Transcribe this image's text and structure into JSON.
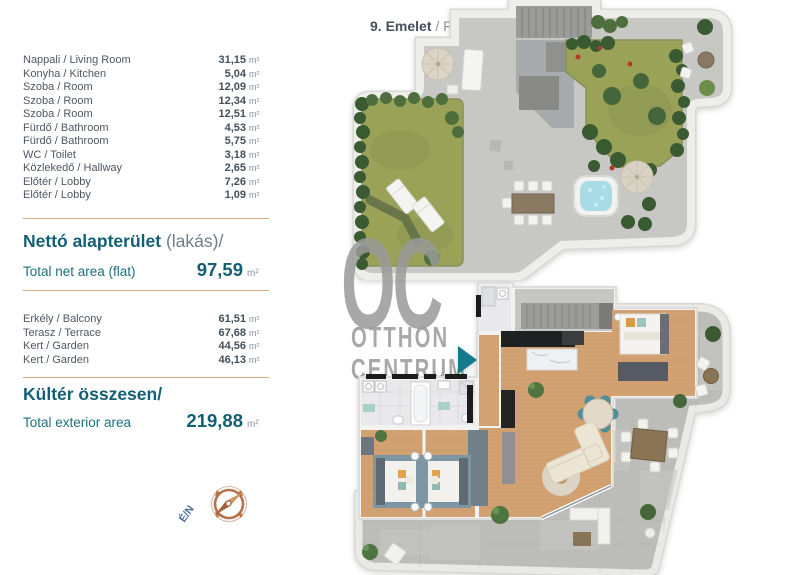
{
  "floor_header": {
    "number": "9. Emelet",
    "sep": " / ",
    "label": "Floor"
  },
  "rooms": [
    {
      "label": "Nappali / Living Room",
      "value": "31,15",
      "unit": "m²"
    },
    {
      "label": "Konyha / Kitchen",
      "value": "5,04",
      "unit": "m²"
    },
    {
      "label": "Szoba / Room",
      "value": "12,09",
      "unit": "m²"
    },
    {
      "label": "Szoba / Room",
      "value": "12,34",
      "unit": "m²"
    },
    {
      "label": "Szoba / Room",
      "value": "12,51",
      "unit": "m²"
    },
    {
      "label": "Fürdő / Bathroom",
      "value": "4,53",
      "unit": "m²"
    },
    {
      "label": "Fürdő / Bathroom",
      "value": "5,75",
      "unit": "m²"
    },
    {
      "label": "WC / Toilet",
      "value": "3,18",
      "unit": "m²"
    },
    {
      "label": "Közlekedő / Hallway",
      "value": "2,65",
      "unit": "m²"
    },
    {
      "label": "Előtér / Lobby",
      "value": "7,26",
      "unit": "m²"
    },
    {
      "label": "Előtér / Lobby",
      "value": "1,09",
      "unit": "m²"
    }
  ],
  "net": {
    "title_hu": "Nettó alapterület ",
    "title_note": "(lakás)/",
    "label_en": "Total net area (flat)",
    "value": "97,59",
    "unit": "m²"
  },
  "exterior": [
    {
      "label": "Erkély / Balcony",
      "value": "61,51",
      "unit": "m²"
    },
    {
      "label": "Terasz / Terrace",
      "value": "67,68",
      "unit": "m²"
    },
    {
      "label": "Kert / Garden",
      "value": "44,56",
      "unit": "m²"
    },
    {
      "label": "Kert / Garden",
      "value": "46,13",
      "unit": "m²"
    }
  ],
  "exterior_total": {
    "title_hu": "Kültér összesen/",
    "label_en": "Total exterior area",
    "value": "219,88",
    "unit": "m²"
  },
  "watermark": {
    "initials": "OC",
    "line1": "OTTHON",
    "line2": "CENTRUM"
  },
  "compass": {
    "label": "É/N"
  },
  "colors": {
    "accent_teal": "#135f74",
    "divider_copper": "#dba87b",
    "entrance_arrow_teal": "#16788c",
    "watermark_gray": "#9a9a9a",
    "compass_copper": "#b57348",
    "grass_green": "#9aa257",
    "wood_floor": "#d1a172",
    "hot_tub_blue": "#a9dbe7"
  }
}
